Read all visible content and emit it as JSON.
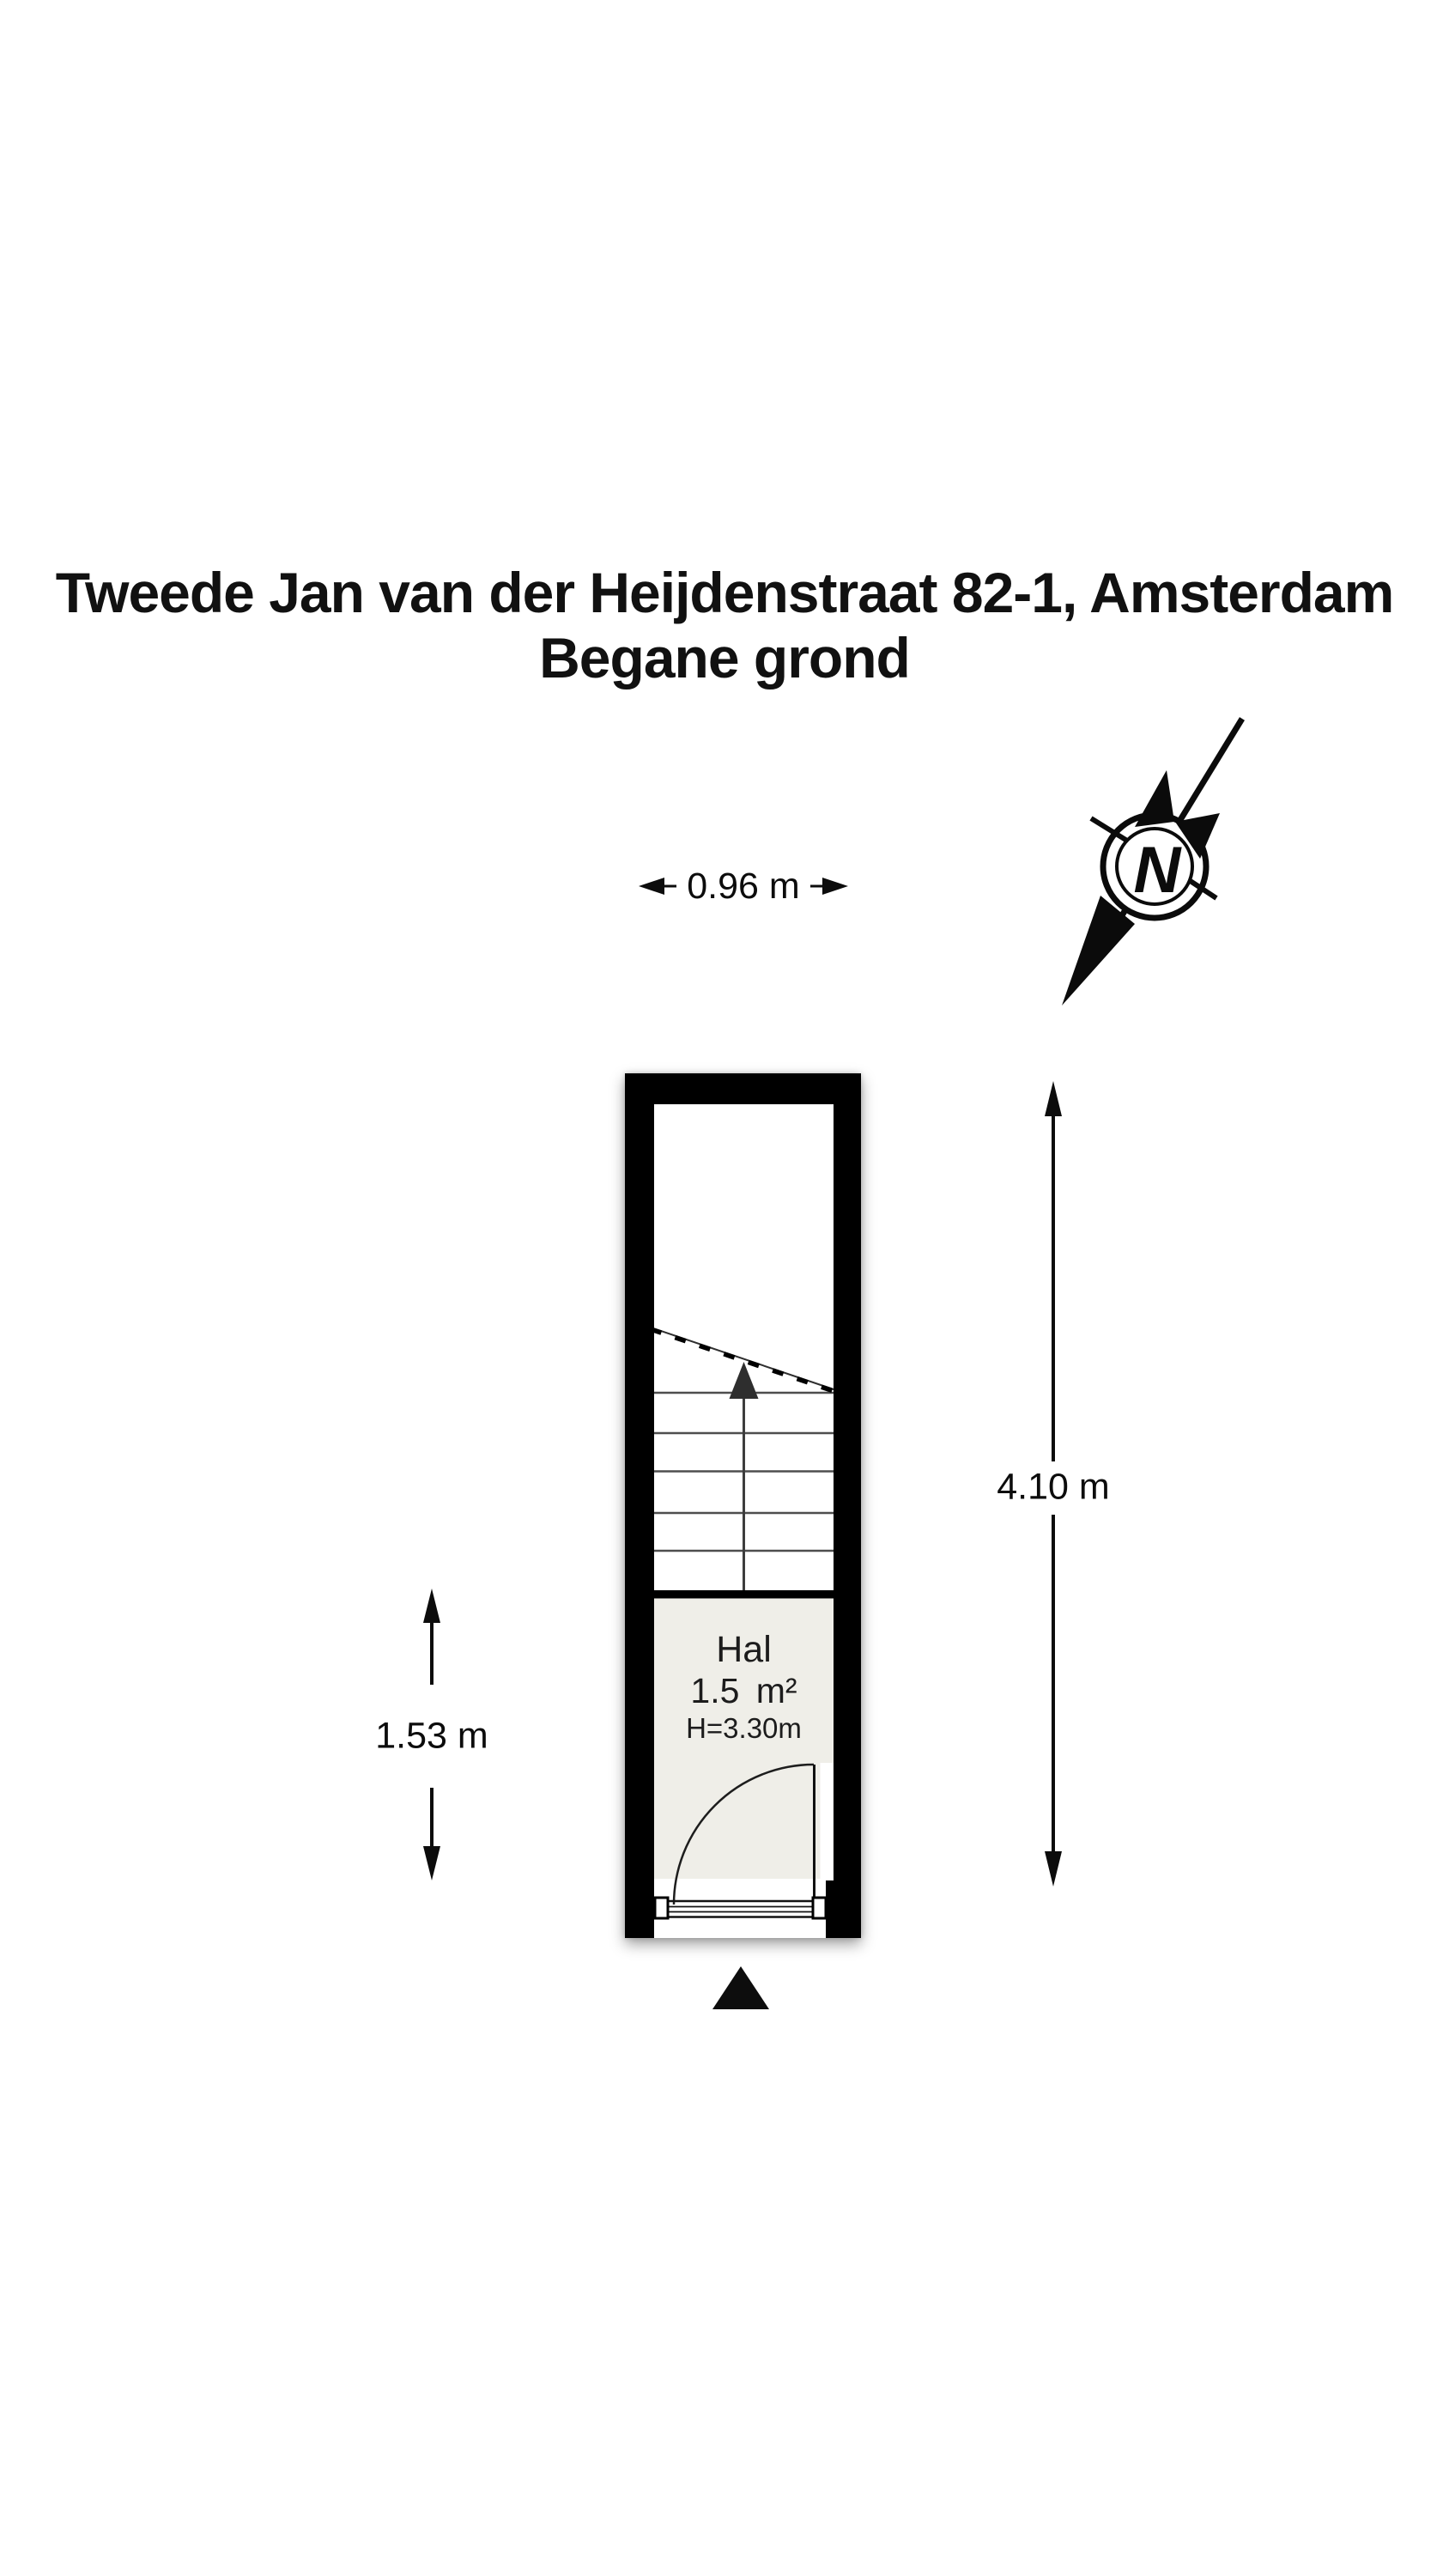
{
  "title": {
    "line1": "Tweede Jan van der Heijdenstraat 82-1, Amsterdam",
    "line2": "Begane grond"
  },
  "compass": {
    "letter": "N"
  },
  "dimensions": {
    "top_width": "0.96 m",
    "right_height": "4.10 m",
    "left_height": "1.53 m"
  },
  "room": {
    "name": "Hal",
    "area": "1.5 m²",
    "ceiling_height": "H=3.30m"
  },
  "colors": {
    "wall": "#000000",
    "hall_floor": "#efeee8",
    "stair_line": "#4e4e4e",
    "text": "#1a1a1a"
  }
}
